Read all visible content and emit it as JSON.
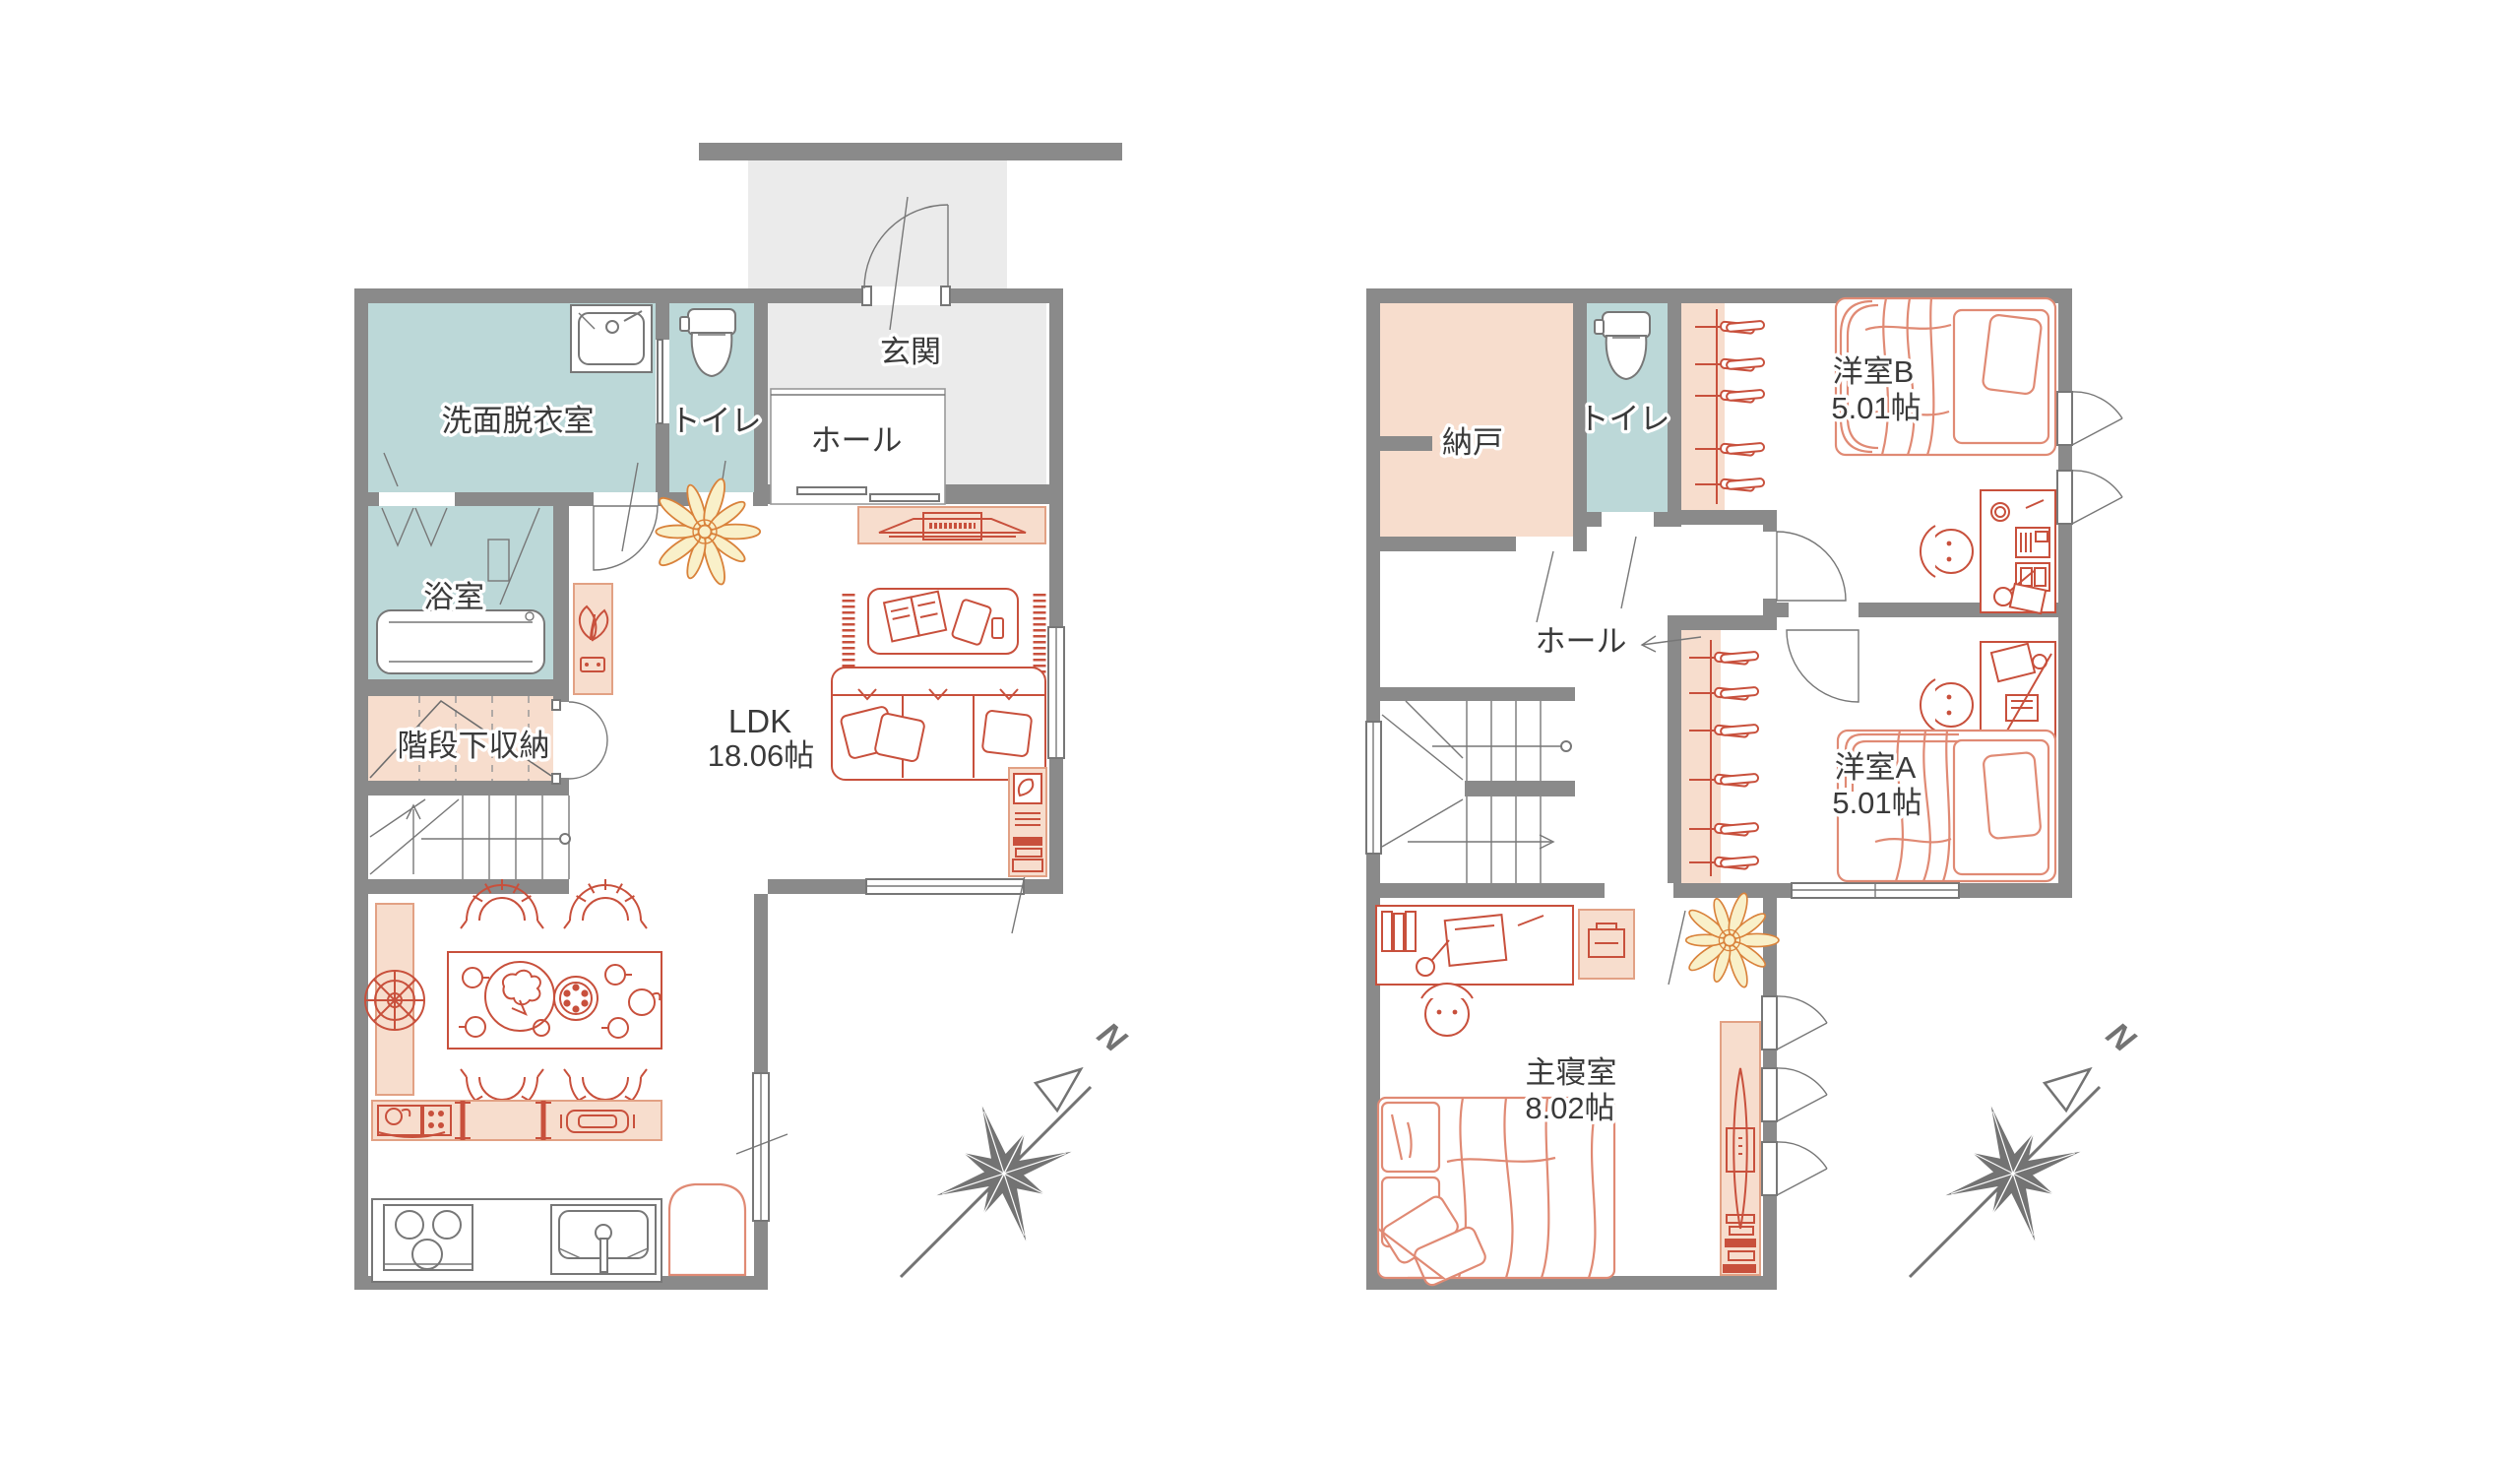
{
  "colors": {
    "wall": "#8A8A8A",
    "teal": "#BCD8D8",
    "peach": "#F7DDCD",
    "peach-stroke": "#E2A184",
    "red": "#C8503C",
    "red-light": "#E08A74",
    "floor-gray": "#EBEBEB",
    "text": "#3A3A3A",
    "line": "#777777",
    "compass": "#737373",
    "plant-fill": "#F9F0C9",
    "plant-stroke": "#D9823B"
  },
  "floor1": {
    "rooms": {
      "entry": {
        "label": "玄関"
      },
      "hall": {
        "label": "ホール"
      },
      "washroom": {
        "label": "洗面脱衣室"
      },
      "toilet": {
        "label": "トイレ"
      },
      "bath": {
        "label": "浴室"
      },
      "understairs": {
        "label": "階段下収納"
      },
      "ldk": {
        "label": "LDK",
        "area": "18.06帖"
      }
    }
  },
  "floor2": {
    "rooms": {
      "storage": {
        "label": "納戸"
      },
      "toilet": {
        "label": "トイレ"
      },
      "roomB": {
        "label": "洋室B",
        "area": "5.01帖"
      },
      "hall": {
        "label": "ホール"
      },
      "roomA": {
        "label": "洋室A",
        "area": "5.01帖"
      },
      "master": {
        "label": "主寝室",
        "area": "8.02帖"
      }
    }
  },
  "compass": {
    "north_label": "N"
  }
}
